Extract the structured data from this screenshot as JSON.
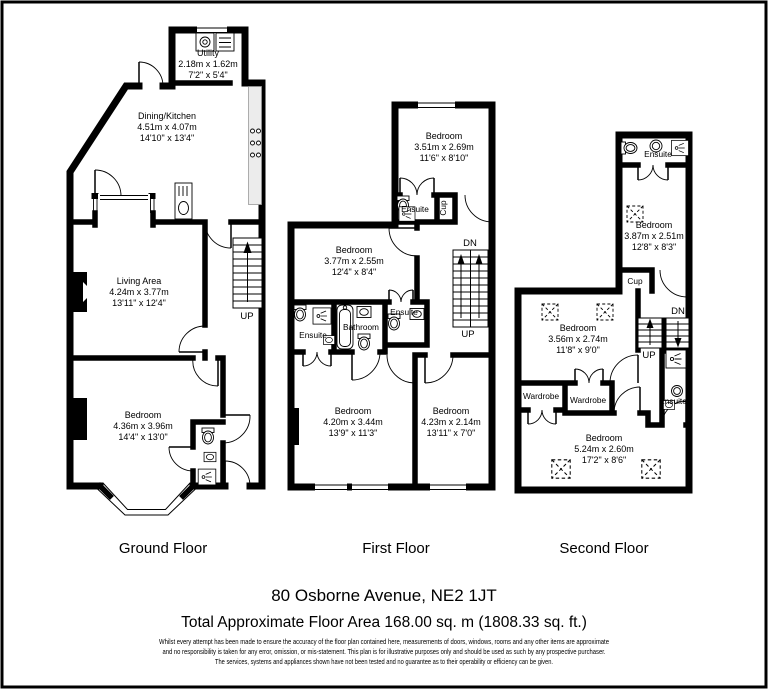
{
  "floors": [
    {
      "label": "Ground Floor",
      "rooms": [
        {
          "name": "Utility",
          "metric": "2.18m x 1.62m",
          "imperial": "7'2\" x 5'4\""
        },
        {
          "name": "Dining/Kitchen",
          "metric": "4.51m x 4.07m",
          "imperial": "14'10\" x 13'4\""
        },
        {
          "name": "Living Area",
          "metric": "4.24m x 3.77m",
          "imperial": "13'11\" x 12'4\""
        },
        {
          "name": "Bedroom",
          "metric": "4.36m x 3.96m",
          "imperial": "14'4\" x 13'0\""
        }
      ],
      "stairs": {
        "up": "UP"
      }
    },
    {
      "label": "First Floor",
      "rooms": [
        {
          "name": "Bedroom",
          "metric": "3.51m x 2.69m",
          "imperial": "11'6\" x 8'10\""
        },
        {
          "name": "Bedroom",
          "metric": "3.77m x 2.55m",
          "imperial": "12'4\" x 8'4\""
        },
        {
          "name": "Bedroom",
          "metric": "4.20m x 3.44m",
          "imperial": "13'9\" x 11'3\""
        },
        {
          "name": "Bedroom",
          "metric": "4.23m x 2.14m",
          "imperial": "13'11\" x 7'0\""
        }
      ],
      "small_rooms": [
        "Ensuite",
        "Cup",
        "Ensuite",
        "Bathroom",
        "Ensuite"
      ],
      "stairs": {
        "up": "UP",
        "down": "DN"
      }
    },
    {
      "label": "Second Floor",
      "rooms": [
        {
          "name": "Bedroom",
          "metric": "3.87m x 2.51m",
          "imperial": "12'8\" x 8'3\""
        },
        {
          "name": "Bedroom",
          "metric": "3.56m x 2.74m",
          "imperial": "11'8\" x 9'0\""
        },
        {
          "name": "Bedroom",
          "metric": "5.24m x 2.60m",
          "imperial": "17'2\" x 8'6\""
        }
      ],
      "small_rooms": [
        "Ensuite",
        "Cup",
        "Wardrobe",
        "Wardrobe",
        "Ensuite"
      ],
      "stairs": {
        "up": "UP",
        "down": "DN"
      }
    }
  ],
  "footer": {
    "address": "80 Osborne Avenue, NE2 1JT",
    "total_area": "Total Approximate Floor Area 168.00 sq. m (1808.33 sq. ft.)",
    "disclaimer": [
      "Whilst every attempt has been made to ensure the accuracy of the floor plan contained here, measurements of doors, windows, rooms and any other items are approximate",
      "and no responsibility is taken for any error, omission, or mis-statement. This plan is for illustrative purposes only and should be used as such by any prospective purchaser.",
      "The services, systems and appliances shown have not been tested and no guarantee as to their operability or efficiency can be given."
    ]
  }
}
